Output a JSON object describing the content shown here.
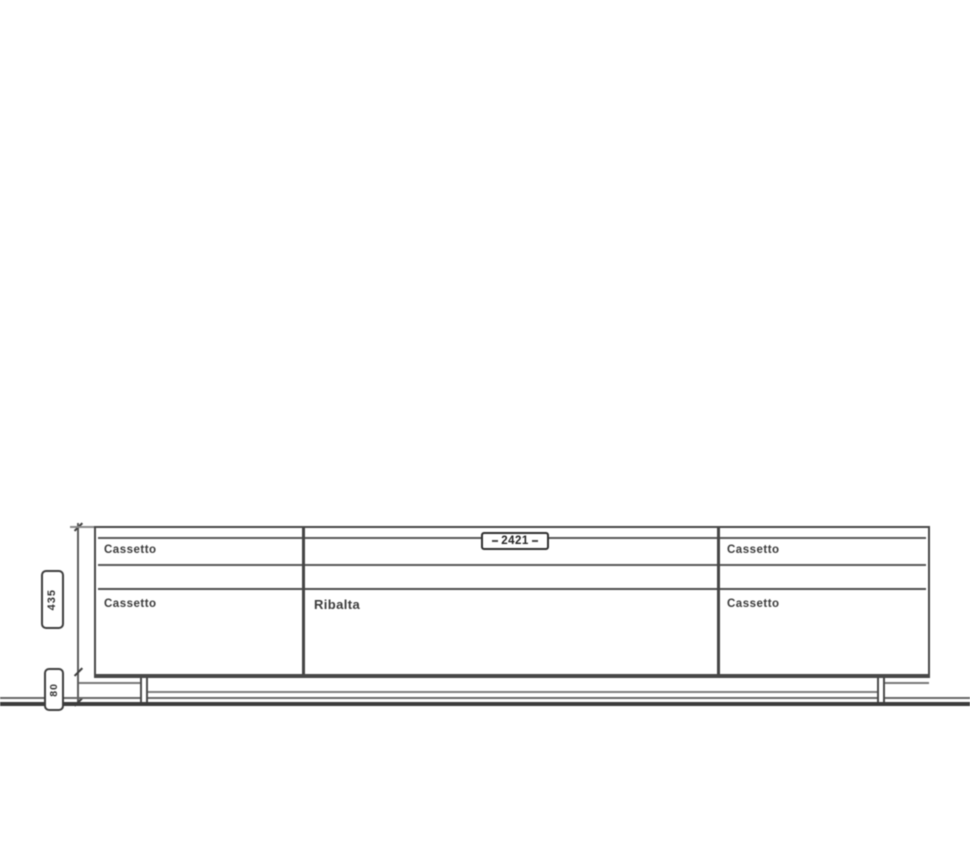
{
  "diagram": {
    "type": "furniture-elevation",
    "dimensions": {
      "width_mm": "2421",
      "body_height_mm": "435",
      "base_height_mm": "80"
    },
    "compartments": {
      "left_top_drawer": "Cassetto",
      "left_bottom_drawer": "Cassetto",
      "center_flap": "Ribalta",
      "right_top_drawer": "Cassetto",
      "right_bottom_drawer": "Cassetto"
    },
    "colors": {
      "line_dark": "#3b3b3b",
      "line_medium": "#4a4a4a",
      "line_light": "#787878",
      "text": "#3a3a3a",
      "background": "#ffffff"
    }
  }
}
